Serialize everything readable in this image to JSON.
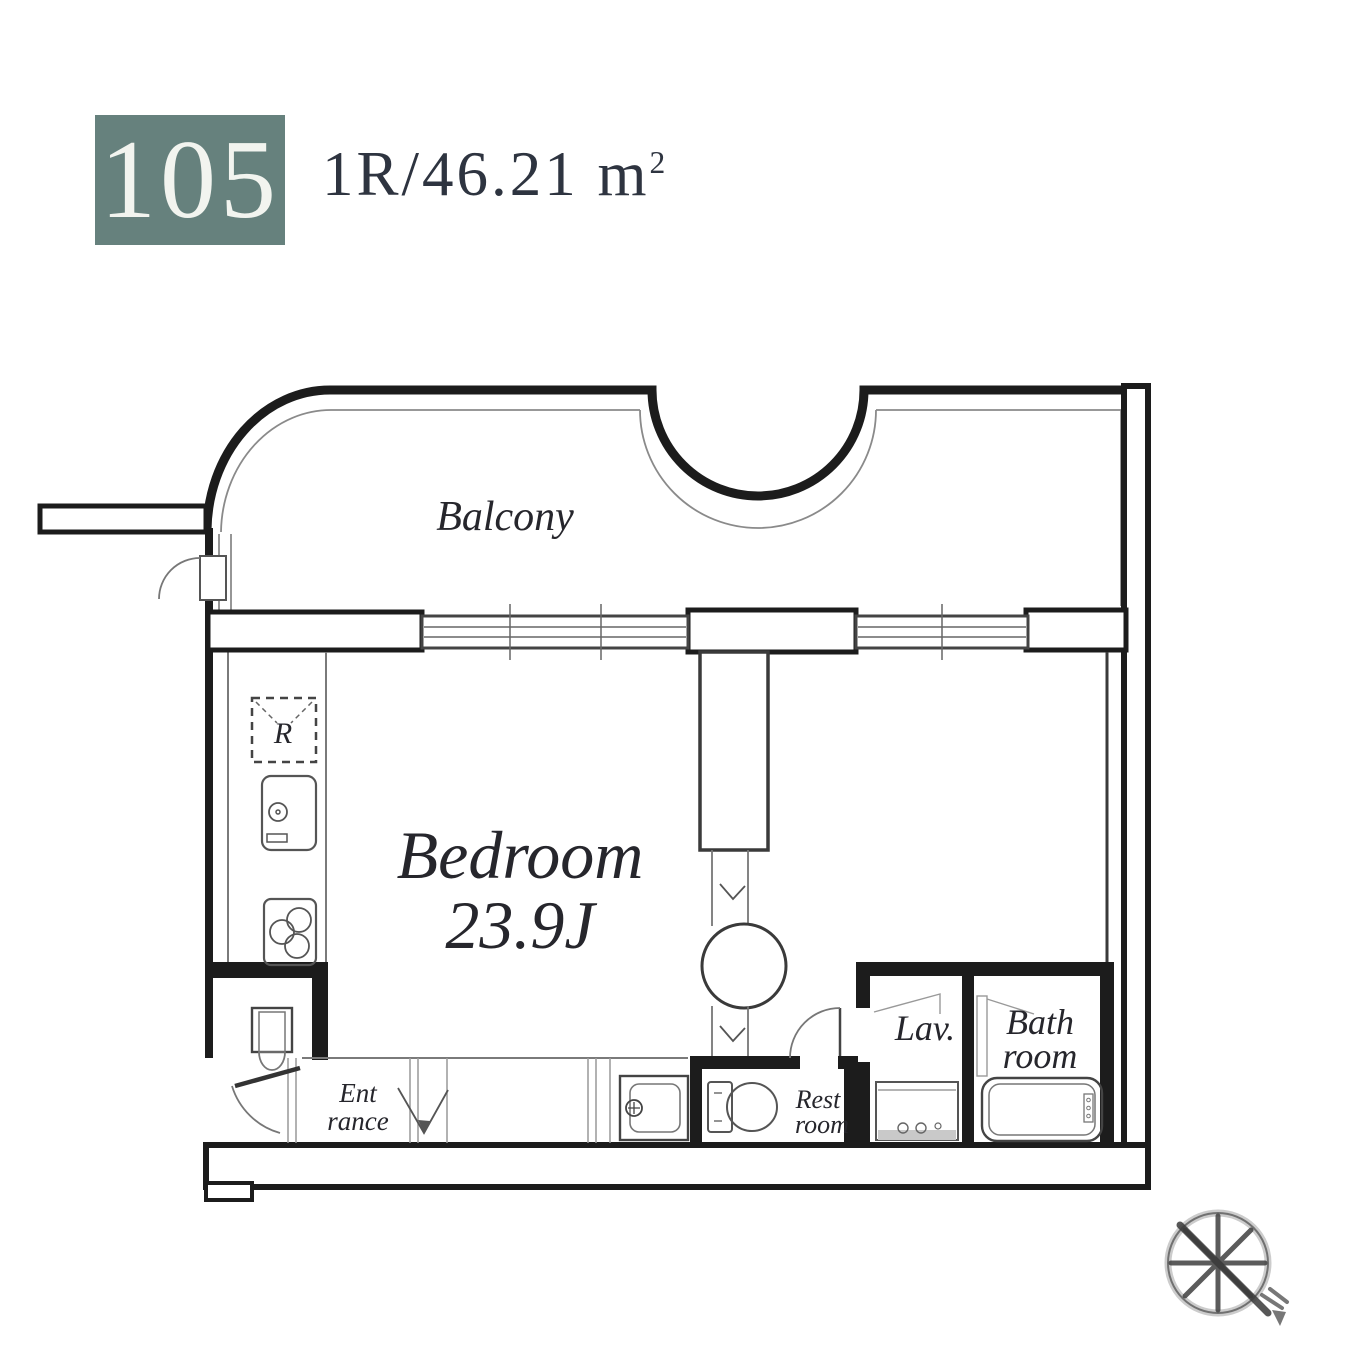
{
  "header": {
    "unit_number": "105",
    "layout_area_main": "1R/46.21 m",
    "layout_area_sup": "2"
  },
  "plan": {
    "balcony_label": "Balcony",
    "bedroom_label": "Bedroom",
    "bedroom_size_label": "23.9J",
    "refrigerator_symbol": "R",
    "entrance_label_line1": "Ent",
    "entrance_label_line2": "rance",
    "restroom_label_line1": "Rest",
    "restroom_label_line2": "room",
    "lavatory_label": "Lav.",
    "bathroom_label_line1": "Bath",
    "bathroom_label_line2": "room"
  },
  "colors": {
    "unit_badge_background": "#66817d",
    "unit_badge_text": "#f2f4ef",
    "spec_text": "#2e3440",
    "wall_line": "#1c1c1c",
    "thin_line": "#7a7a7a",
    "label_text": "#26262c"
  }
}
